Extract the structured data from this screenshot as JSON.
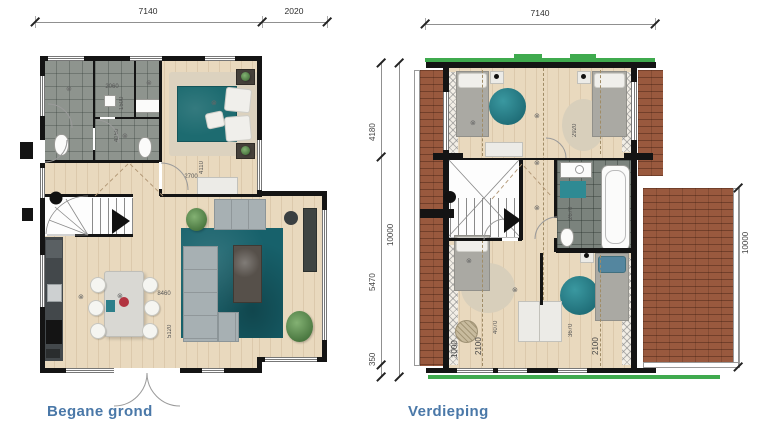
{
  "ground_floor": {
    "label": "Begane grond",
    "dims": {
      "width_main": "7140",
      "width_ext": "2020",
      "living_w": "8460",
      "living_d": "5120",
      "bed_d": "4110",
      "bed_w": "2700",
      "bath_w": "2060",
      "bath_a": "1500",
      "bath_b": "4150"
    }
  },
  "upper_floor": {
    "label": "Verdieping",
    "dims": {
      "width": "7140",
      "h_top": "4180",
      "h_total_left": "10000",
      "h_mid": "5470",
      "h_bot": "350",
      "h_total_right": "10000",
      "bed_tr": "2920",
      "bath": "2670",
      "bed_bl": "4070",
      "bed_br": "3670",
      "knee_left": "2100",
      "knee_right": "2100",
      "knee_edge": "1000"
    }
  },
  "symbols": {
    "ceiling_light": "⊗"
  },
  "colors": {
    "accent_green": "#3faa4e",
    "label_blue": "#4a78a8",
    "teal": "#17616b",
    "roof_brown": "#99593e"
  }
}
